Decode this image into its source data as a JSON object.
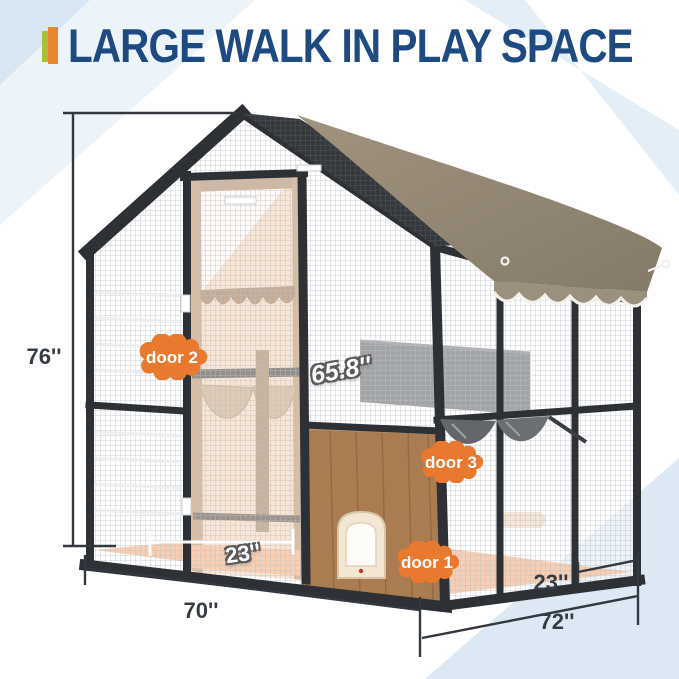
{
  "header": {
    "title": "LARGE WALK IN PLAY SPACE",
    "accent_bar_colors": {
      "green": "#a5c13c",
      "orange": "#e8862d"
    },
    "title_color": "#1d4a80"
  },
  "diagram": {
    "product": "walk-in pet enclosure with mesh panels, canopy roof and cat flap",
    "dimensions": {
      "height": "76''",
      "front_width": "70''",
      "depth": "72''",
      "depth_section": "23''",
      "door_width": "23''",
      "door_height": "65.8''"
    },
    "doors": [
      {
        "label": "door 1"
      },
      {
        "label": "door 2"
      },
      {
        "label": "door 3"
      }
    ],
    "colors": {
      "badge_orange": "#e8792e",
      "canopy_taupe": "#968a7a",
      "frame_dark": "#2d3034",
      "wood_brown": "#aa7c52",
      "interior_peach": "#f3cfb0",
      "floor_orange": "#efa577",
      "corner_blue": "#dce9f4",
      "dimension_line": "#333840"
    }
  }
}
